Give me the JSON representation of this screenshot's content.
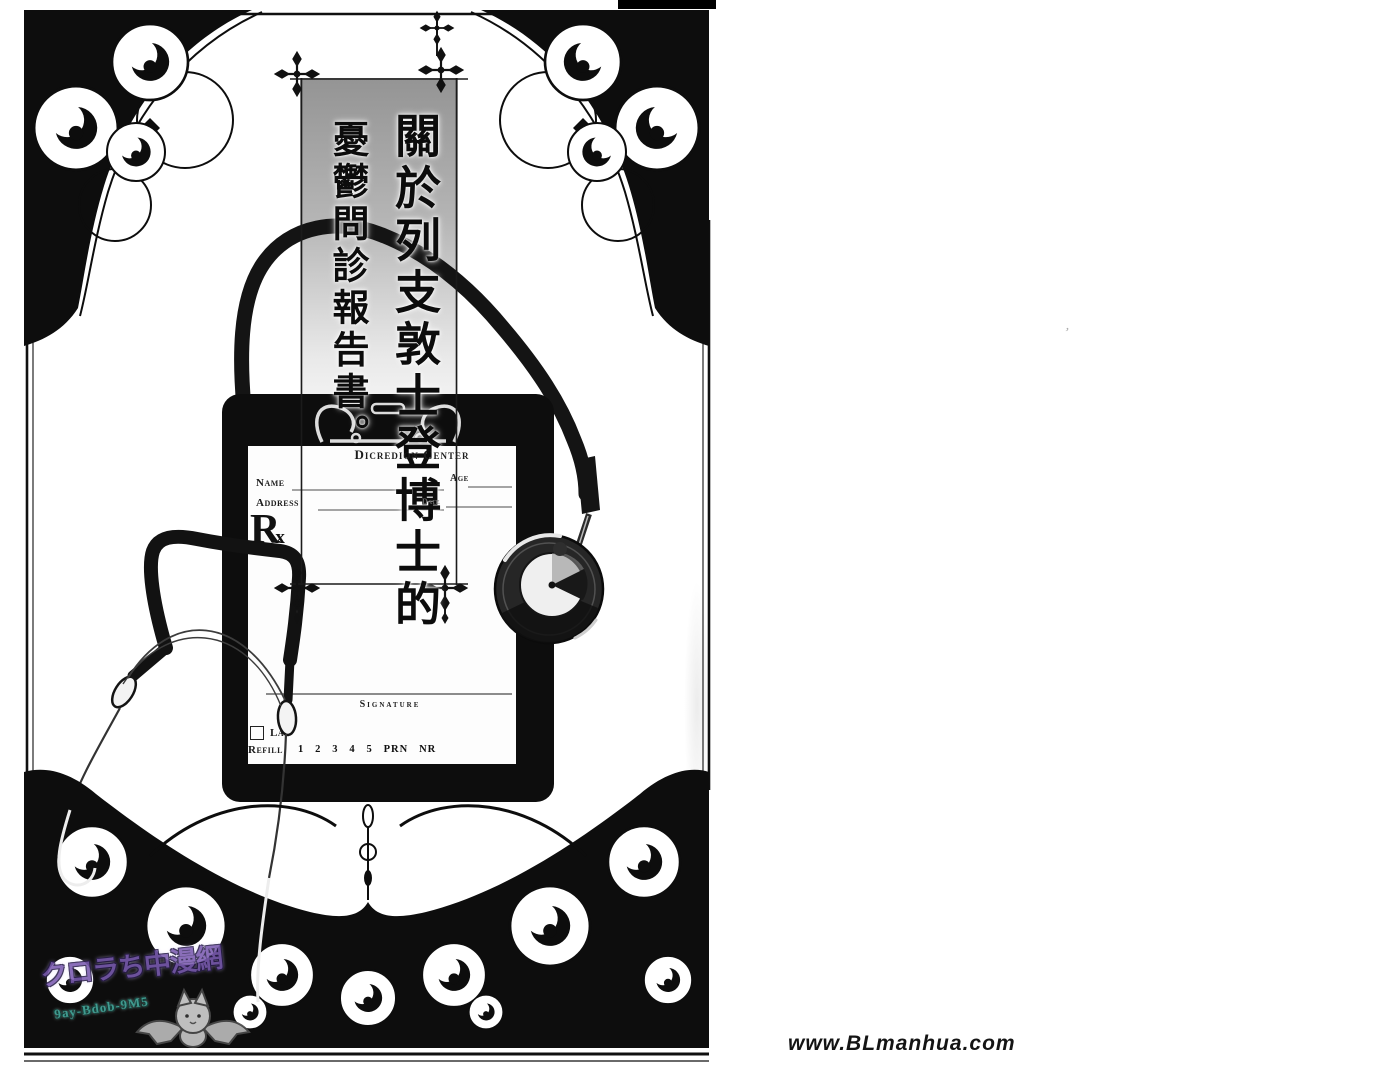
{
  "page": {
    "title": {
      "right_column": "關於列支敦士登博士的",
      "left_column": "憂鬱問診報告書。"
    },
    "prescription": {
      "clinic_header": "Dicredion Center",
      "name_label": "Name",
      "age_label": "Age",
      "address_label": "Address",
      "date_label": "Date",
      "rx_symbol": "Rx",
      "signature_label": "Signature",
      "lab_label": "La",
      "refill_label": "Refill",
      "refill_options": "1   2   3   4   5   PRN   NR"
    },
    "watermark": {
      "line1": "クロラち中漫網",
      "line2": "9ay-Bdob-9M5"
    }
  },
  "footer": {
    "site_credit": "www.BLmanhua.com"
  },
  "artifact": {
    "stray_mark": "’"
  },
  "colors": {
    "ink": "#0d0d0d",
    "banner_gray_top": "#949494",
    "watermark_purple": "#7a5bb0",
    "watermark_teal": "#49b3a6",
    "mascot_gray": "#c6c6c6"
  }
}
